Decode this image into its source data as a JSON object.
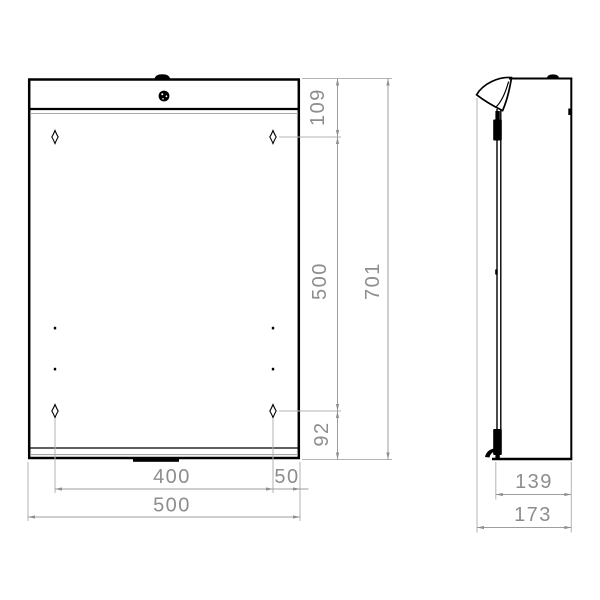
{
  "drawing": {
    "type": "technical-dimension-drawing",
    "views": {
      "front": {
        "dims": {
          "top_to_hole": "109",
          "hole_spacing_vertical": "500",
          "hole_to_bottom": "92",
          "overall_height": "701",
          "hole_spacing_horizontal": "400",
          "hole_to_edge": "50",
          "overall_width": "500"
        }
      },
      "side": {
        "dims": {
          "body_depth": "139",
          "overall_depth": "173"
        }
      }
    },
    "colors": {
      "outline": "#000000",
      "dimension_line": "#9e9e9e",
      "dimension_text": "#8d8d8d",
      "background": "#ffffff"
    }
  }
}
